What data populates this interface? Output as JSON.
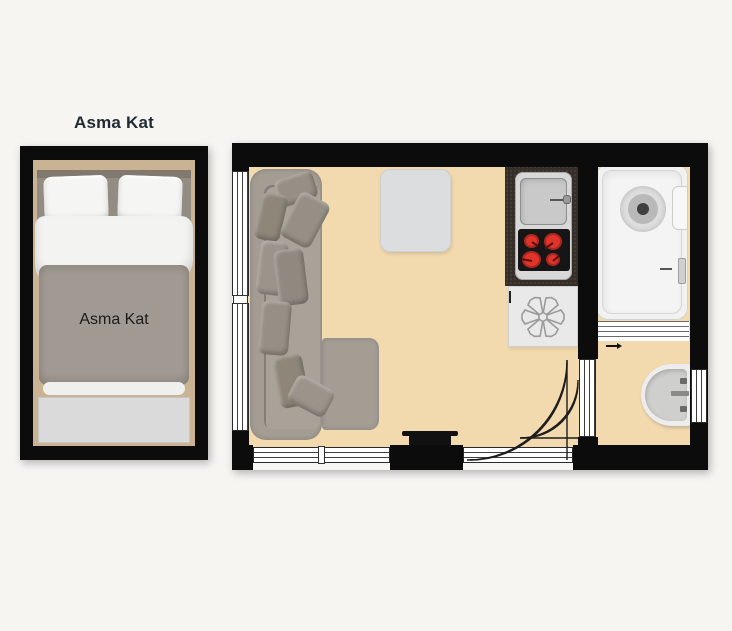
{
  "mezzanine": {
    "title": "Asma Kat",
    "bed_label": "Asma Kat"
  },
  "icons": {
    "fan_unit_symbol": "six-spoke-asterisk",
    "door_swing_symbol": "quarter-arc"
  },
  "colors": {
    "background": "#f7f5f2",
    "wall": "#0c0c0c",
    "floor": "#f2d9ae",
    "lining": "#c9b393",
    "window_line": "#3e3e3e",
    "sofa": "#a39d94",
    "pillow": "#968f85",
    "table": "#dcddde",
    "counter": "#362f29",
    "appliance_frame": "#d8d8d8",
    "sink": "#c9c9c9",
    "cooktop": "#161616",
    "burner": "#e0342b",
    "fan_box": "#e9e9e9",
    "tub": "#f1f1f1",
    "basin": "#ededed",
    "bed_blanket": "#a09a92",
    "bed_duvet": "#f3f3f2",
    "bench": "#dadada",
    "tv": "#111111",
    "title_color": "#1f2a33",
    "arc_line": "#1c1c1c"
  }
}
